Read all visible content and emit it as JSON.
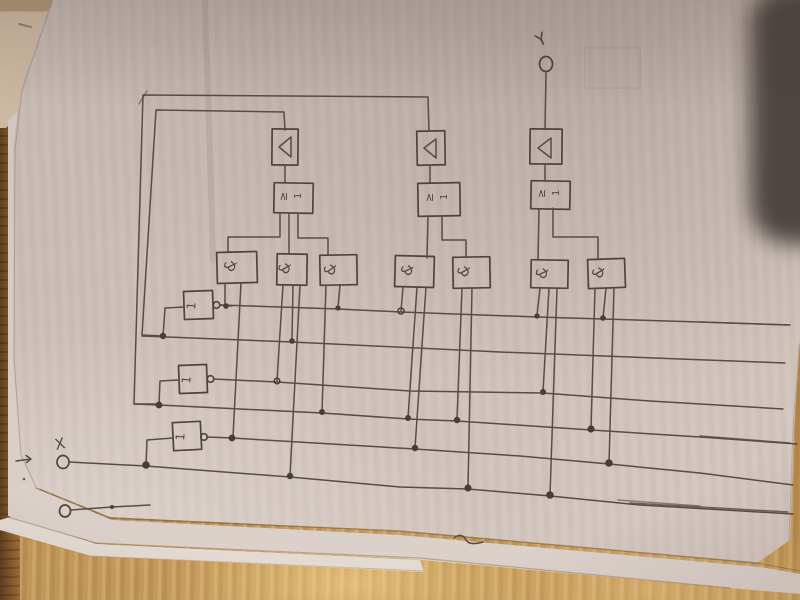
{
  "diagram": {
    "title": "hand-drawn logic circuit on paper",
    "output_label": "Y",
    "input_label": "X",
    "gate_labels": {
      "or": "≥1",
      "and": "&",
      "not": "1"
    },
    "gate_counts": {
      "buffer_triangles": 3,
      "or_gates": 3,
      "and_gates": 7,
      "not_gates": 3
    },
    "bus_row_count": 6,
    "colors": {
      "ink": "#4d453c",
      "paper": "#cec0b9",
      "wood": "#b8884a",
      "dark_object": "#49443f"
    }
  }
}
